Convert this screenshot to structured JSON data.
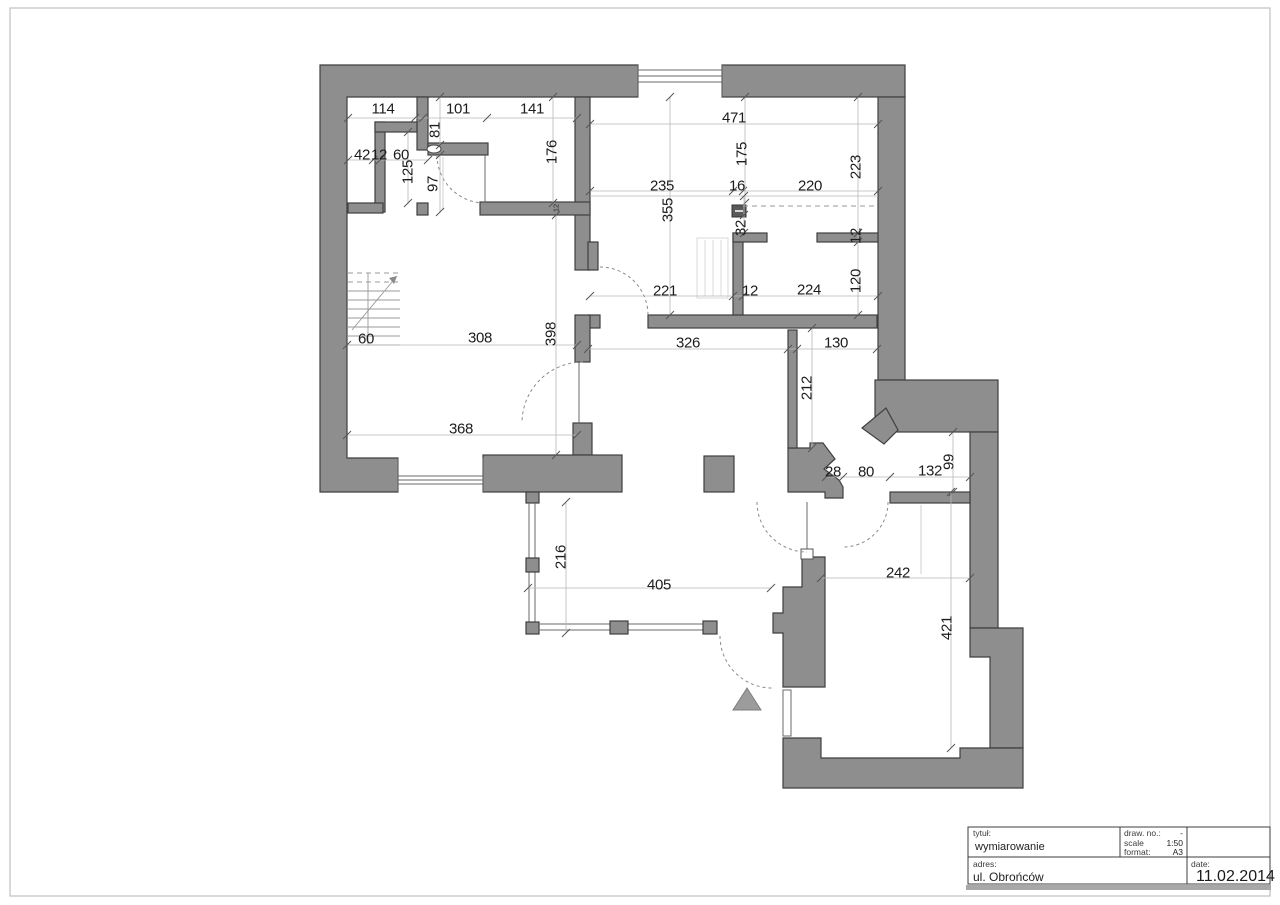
{
  "drawing": {
    "type": "architectural floor plan",
    "entrance_marker": "triangle-up"
  },
  "colors": {
    "wall_fill": "#8e8e8e",
    "wall_outline": "#3f3f3f",
    "dimension_text": "#1c1c1c",
    "dimension_line": "#b8b8b8",
    "page_frame": "#b3b3b3",
    "title_shadow": "#a8a8a8"
  },
  "title_block": {
    "tytul_label": "tytuł:",
    "tytul_value": "wymiarowanie",
    "draw_no_label": "draw. no.:",
    "draw_no_value": "-",
    "scale_label": "scale",
    "scale_value": "1:50",
    "format_label": "format:",
    "format_value": "A3",
    "adres_label": "adres:",
    "adres_value": "ul. Obrońców",
    "date_label": "date:",
    "date_value": "11.02.2014"
  },
  "dimensions": [
    {
      "text": "114",
      "x": 383,
      "y": 108,
      "rot": 0
    },
    {
      "text": "101",
      "x": 458,
      "y": 108,
      "rot": 0
    },
    {
      "text": "141",
      "x": 532,
      "y": 108,
      "rot": 0
    },
    {
      "text": "471",
      "x": 734,
      "y": 117,
      "rot": 0
    },
    {
      "text": "42",
      "x": 362,
      "y": 154,
      "rot": 0
    },
    {
      "text": "12",
      "x": 379,
      "y": 154,
      "rot": 0
    },
    {
      "text": "60",
      "x": 401,
      "y": 154,
      "rot": 0
    },
    {
      "text": "81",
      "x": 434,
      "y": 130,
      "rot": 90
    },
    {
      "text": "176",
      "x": 551,
      "y": 152,
      "rot": 90
    },
    {
      "text": "175",
      "x": 741,
      "y": 154,
      "rot": 90
    },
    {
      "text": "223",
      "x": 855,
      "y": 167,
      "rot": 90
    },
    {
      "text": "125",
      "x": 407,
      "y": 172,
      "rot": 90
    },
    {
      "text": "97",
      "x": 432,
      "y": 184,
      "rot": 90
    },
    {
      "text": "235",
      "x": 662,
      "y": 185,
      "rot": 0
    },
    {
      "text": "16",
      "x": 737,
      "y": 185,
      "rot": 0
    },
    {
      "text": "220",
      "x": 810,
      "y": 185,
      "rot": 0
    },
    {
      "text": "355",
      "x": 667,
      "y": 210,
      "rot": 90
    },
    {
      "text": "32",
      "x": 740,
      "y": 228,
      "rot": 90
    },
    {
      "text": "12",
      "x": 556,
      "y": 208,
      "rot": 90,
      "small": true
    },
    {
      "text": "12",
      "x": 855,
      "y": 236,
      "rot": 90
    },
    {
      "text": "221",
      "x": 665,
      "y": 290,
      "rot": 0
    },
    {
      "text": "12",
      "x": 750,
      "y": 290,
      "rot": 0
    },
    {
      "text": "224",
      "x": 809,
      "y": 289,
      "rot": 0
    },
    {
      "text": "120",
      "x": 855,
      "y": 281,
      "rot": 90
    },
    {
      "text": "60",
      "x": 366,
      "y": 338,
      "rot": 0
    },
    {
      "text": "308",
      "x": 480,
      "y": 337,
      "rot": 0
    },
    {
      "text": "398",
      "x": 550,
      "y": 334,
      "rot": 90
    },
    {
      "text": "326",
      "x": 688,
      "y": 342,
      "rot": 0
    },
    {
      "text": "130",
      "x": 836,
      "y": 342,
      "rot": 0
    },
    {
      "text": "212",
      "x": 806,
      "y": 388,
      "rot": 90
    },
    {
      "text": "368",
      "x": 461,
      "y": 428,
      "rot": 0
    },
    {
      "text": "28",
      "x": 833,
      "y": 471,
      "rot": 0
    },
    {
      "text": "80",
      "x": 866,
      "y": 471,
      "rot": 0
    },
    {
      "text": "132",
      "x": 930,
      "y": 470,
      "rot": 0
    },
    {
      "text": "99",
      "x": 948,
      "y": 462,
      "rot": 90
    },
    {
      "text": "216",
      "x": 560,
      "y": 557,
      "rot": 90
    },
    {
      "text": "405",
      "x": 659,
      "y": 584,
      "rot": 0
    },
    {
      "text": "242",
      "x": 898,
      "y": 572,
      "rot": 0
    },
    {
      "text": "421",
      "x": 946,
      "y": 628,
      "rot": 90
    }
  ],
  "dim_lines": {
    "horizontal": [
      {
        "y": 118,
        "x1": 348,
        "x2": 577,
        "ticks": [
          348,
          415,
          423,
          487,
          577
        ]
      },
      {
        "y": 124,
        "x1": 590,
        "x2": 878,
        "ticks": [
          590,
          878
        ]
      },
      {
        "y": 160,
        "x1": 348,
        "x2": 428,
        "ticks": [
          348,
          373,
          380,
          428
        ]
      },
      {
        "y": 191,
        "x1": 590,
        "x2": 878,
        "ticks": [
          590,
          733,
          743,
          878
        ]
      },
      {
        "y": 196,
        "x1": 590,
        "x2": 878,
        "ticks": []
      },
      {
        "y": 296,
        "x1": 590,
        "x2": 878,
        "ticks": [
          590,
          733,
          743,
          878
        ]
      },
      {
        "y": 349,
        "x1": 588,
        "x2": 877,
        "ticks": [
          588,
          788,
          797,
          877
        ]
      },
      {
        "y": 477,
        "x1": 826,
        "x2": 970,
        "ticks": [
          826,
          843,
          890,
          970
        ]
      },
      {
        "y": 588,
        "x1": 528,
        "x2": 771,
        "ticks": [
          528,
          771
        ]
      },
      {
        "y": 578,
        "x1": 821,
        "x2": 970,
        "ticks": [
          821,
          970
        ]
      },
      {
        "y": 345,
        "x1": 347,
        "x2": 577,
        "ticks": [
          347,
          577
        ]
      },
      {
        "y": 435,
        "x1": 347,
        "x2": 577,
        "ticks": [
          347,
          577
        ]
      }
    ],
    "vertical": [
      {
        "x": 440,
        "y1": 97,
        "y2": 145,
        "ticks": [
          97,
          145
        ]
      },
      {
        "x": 408,
        "y1": 132,
        "y2": 203,
        "ticks": [
          132,
          203
        ]
      },
      {
        "x": 440,
        "y1": 155,
        "y2": 212,
        "ticks": [
          155,
          212
        ]
      },
      {
        "x": 553,
        "y1": 97,
        "y2": 203,
        "ticks": [
          97,
          203
        ]
      },
      {
        "x": 745,
        "y1": 97,
        "y2": 203,
        "ticks": [
          97,
          203
        ]
      },
      {
        "x": 858,
        "y1": 97,
        "y2": 233,
        "ticks": [
          97,
          233
        ]
      },
      {
        "x": 670,
        "y1": 97,
        "y2": 315,
        "ticks": [
          97,
          315
        ]
      },
      {
        "x": 744,
        "y1": 196,
        "y2": 233,
        "ticks": [
          196,
          215,
          233
        ]
      },
      {
        "x": 858,
        "y1": 233,
        "y2": 315,
        "ticks": [
          233,
          242,
          315
        ]
      },
      {
        "x": 556,
        "y1": 215,
        "y2": 455,
        "ticks": [
          215,
          455
        ]
      },
      {
        "x": 812,
        "y1": 328,
        "y2": 448,
        "ticks": [
          328,
          448
        ]
      },
      {
        "x": 953,
        "y1": 432,
        "y2": 492,
        "ticks": [
          432,
          492
        ]
      },
      {
        "x": 566,
        "y1": 502,
        "y2": 633,
        "ticks": [
          502,
          633
        ]
      },
      {
        "x": 951,
        "y1": 492,
        "y2": 748,
        "ticks": [
          492,
          748
        ]
      }
    ]
  }
}
